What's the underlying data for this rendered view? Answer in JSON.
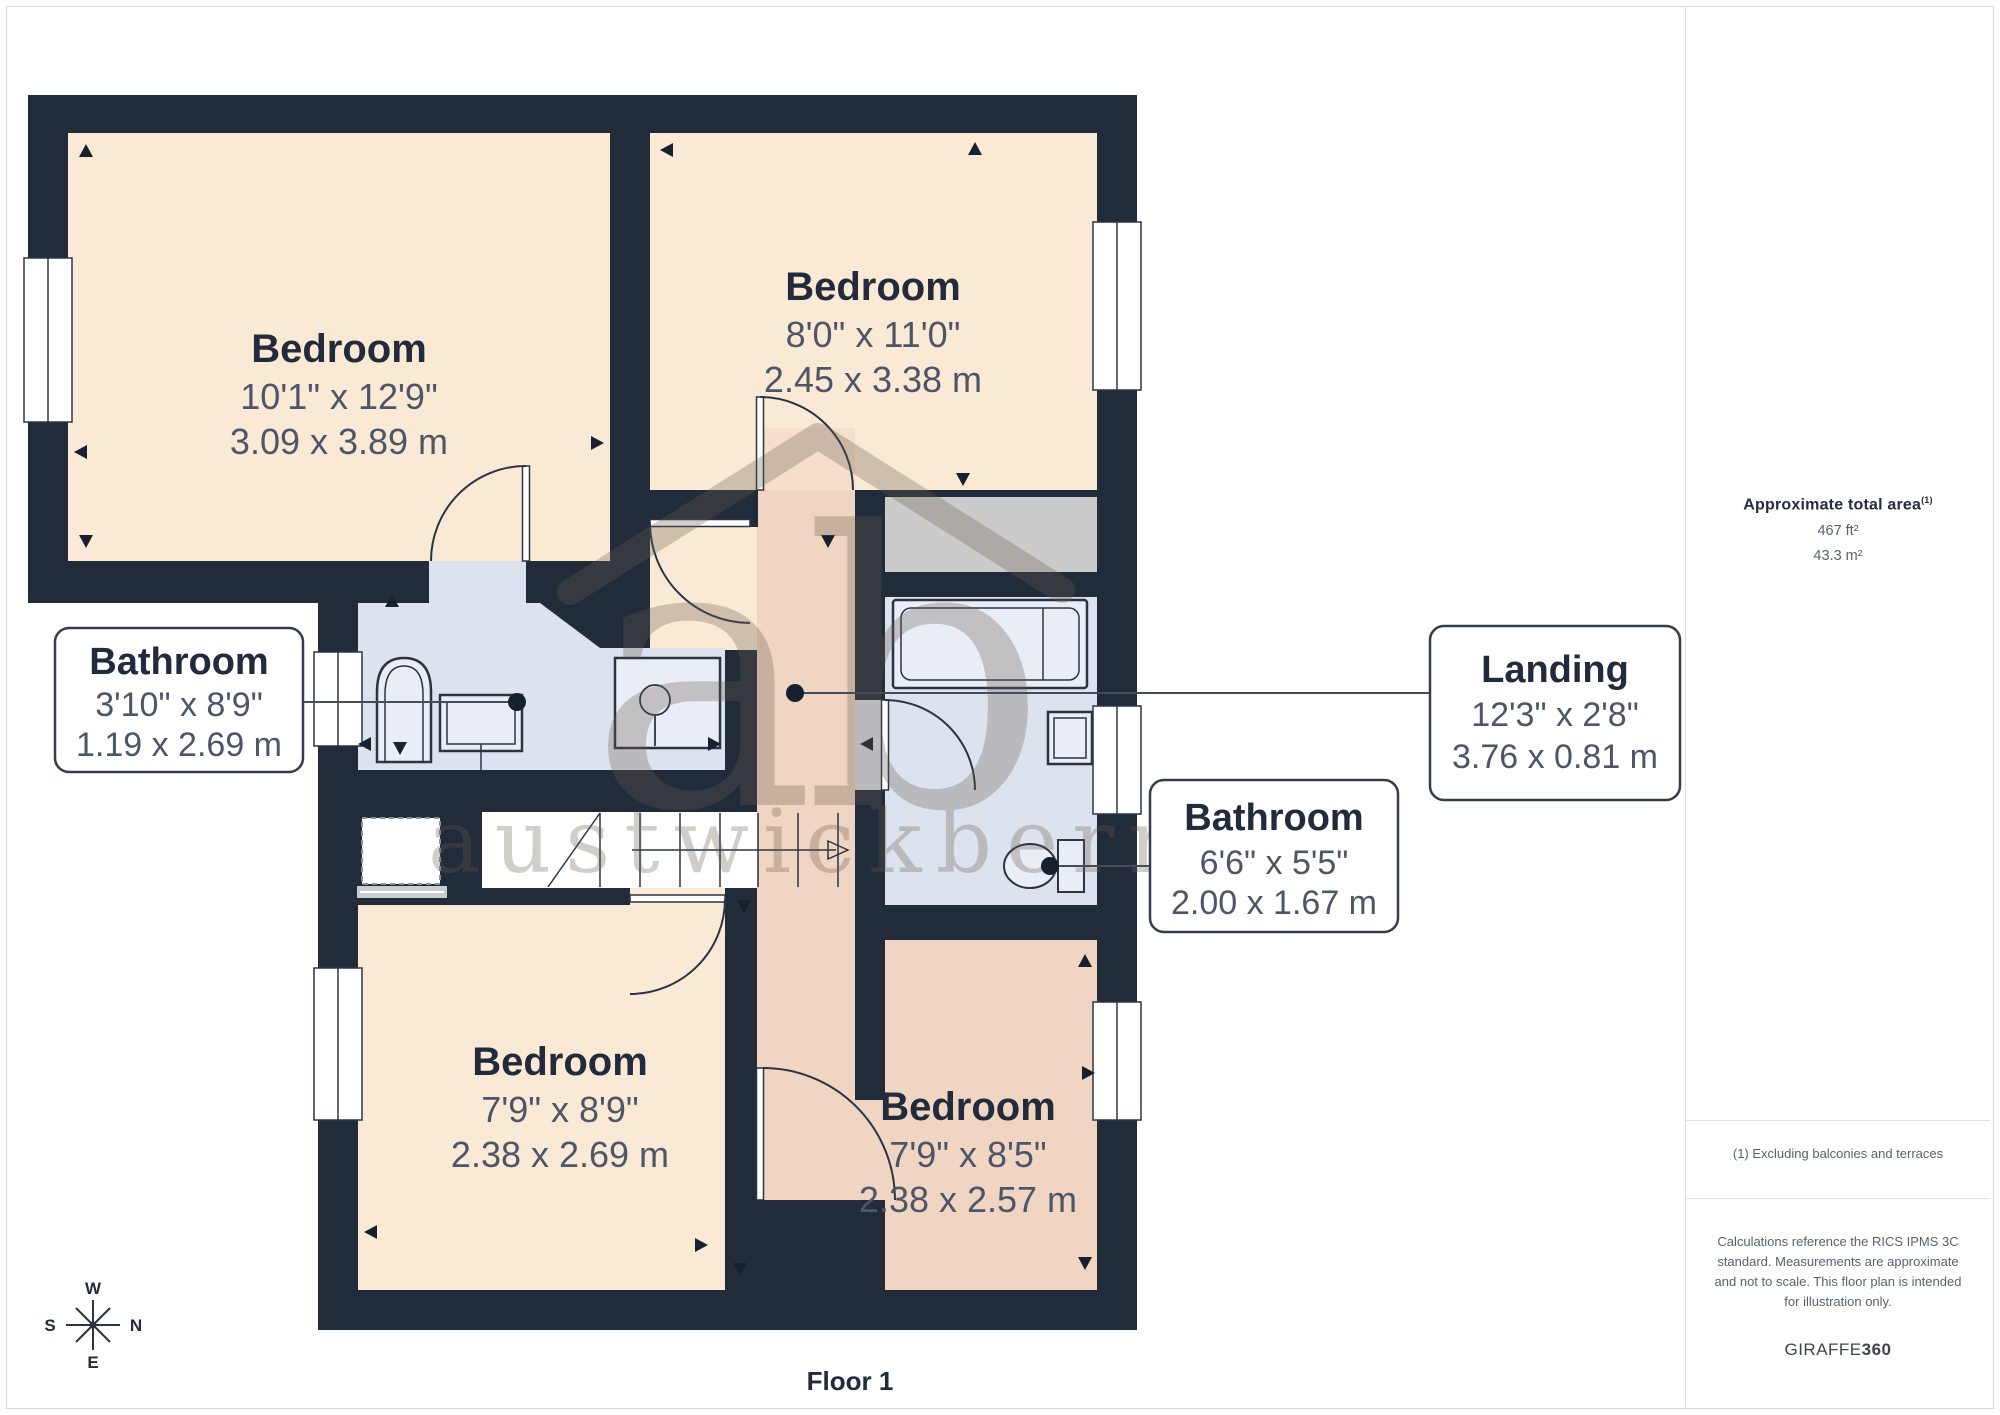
{
  "floor_label": "Floor 1",
  "rooms": [
    {
      "id": "bedroom-top-left",
      "name": "Bedroom",
      "dims_ft": "10'1\" x 12'9\"",
      "dims_m": "3.09 x 3.89 m"
    },
    {
      "id": "bedroom-top-right",
      "name": "Bedroom",
      "dims_ft": "8'0\" x 11'0\"",
      "dims_m": "2.45 x 3.38 m"
    },
    {
      "id": "bedroom-bottom-left",
      "name": "Bedroom",
      "dims_ft": "7'9\" x 8'9\"",
      "dims_m": "2.38 x 2.69 m"
    },
    {
      "id": "bedroom-bottom-right",
      "name": "Bedroom",
      "dims_ft": "7'9\" x 8'5\"",
      "dims_m": "2.38 x 2.57 m"
    }
  ],
  "callouts": [
    {
      "id": "bathroom-left",
      "name": "Bathroom",
      "dims_ft": "3'10\" x 8'9\"",
      "dims_m": "1.19 x 2.69 m"
    },
    {
      "id": "landing",
      "name": "Landing",
      "dims_ft": "12'3\" x 2'8\"",
      "dims_m": "3.76 x 0.81 m"
    },
    {
      "id": "bathroom-right",
      "name": "Bathroom",
      "dims_ft": "6'6\" x 5'5\"",
      "dims_m": "2.00 x 1.67 m"
    }
  ],
  "compass": {
    "n": "N",
    "s": "S",
    "e": "E",
    "w": "W"
  },
  "watermark": {
    "initials": "ab",
    "name": "austwickberry"
  },
  "sidebar": {
    "area_title": "Approximate total area",
    "area_sup": "(1)",
    "area_ft": "467 ft²",
    "area_m": "43.3 m²",
    "note": "(1) Excluding balconies and terraces",
    "disclaimer": "Calculations reference the RICS IPMS 3C standard. Measurements are approximate and not to scale. This floor plan is intended for illustration only.",
    "brand": "GIRAFFE",
    "brand_suffix": "360"
  },
  "colors": {
    "wall": "#212b3a",
    "bedroom_fill": "#fae9d4",
    "highlight_fill": "#f0d5c2",
    "bathroom_fill": "#dde3ee",
    "closet_gray": "#cbcbcb",
    "fixture_fill": "#e9edf5",
    "label_name": "#212b3b",
    "label_dims": "#4d5668",
    "watermark": "#6b5c4f",
    "border_gray": "#dcdcdc"
  }
}
